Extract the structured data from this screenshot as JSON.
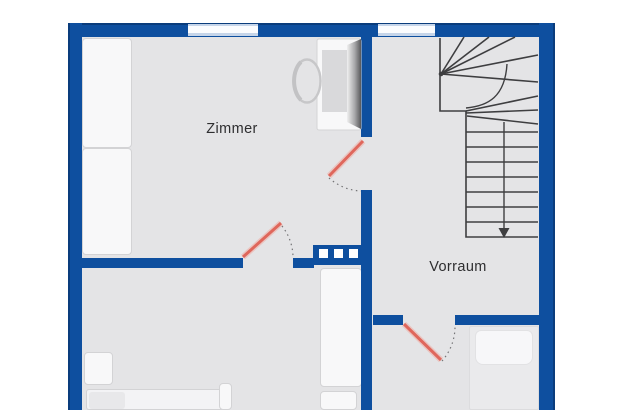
{
  "plan": {
    "rooms": {
      "zimmer": {
        "label": "Zimmer"
      },
      "vorraum": {
        "label": "Vorraum"
      }
    },
    "symbols": {
      "staircase": "quarter-winder stairs, walkline arrow pointing down",
      "doors": "3 swing doors drawn as red leaf with dotted swing arc",
      "chimney": "wall block with three white squares",
      "windows": "2 windows in top exterior wall"
    }
  },
  "colors": {
    "wall": "#0e4f9f",
    "wall-edge": "#0a3c7c",
    "floor": "#e4e4e6",
    "furniture": "#f8f8f9",
    "furniture-border": "#d3d3d5",
    "bed-left": "#f3f3f5",
    "pillow-left": "#e8e8ea",
    "bed-right": "#eaeaec",
    "pillow-right": "#f7f7f9",
    "door-leaf": "#df675c",
    "door-leaf-halo": "#f0a79e",
    "swing-arc": "#757577",
    "window-frame": "#c6d5e9",
    "window-glass": "#fbfcfe",
    "stair-line": "#3e3e40",
    "label-text": "#2e2e30",
    "cabinet-inner": "#d9d9db",
    "chimney-square": "#ffffff"
  }
}
